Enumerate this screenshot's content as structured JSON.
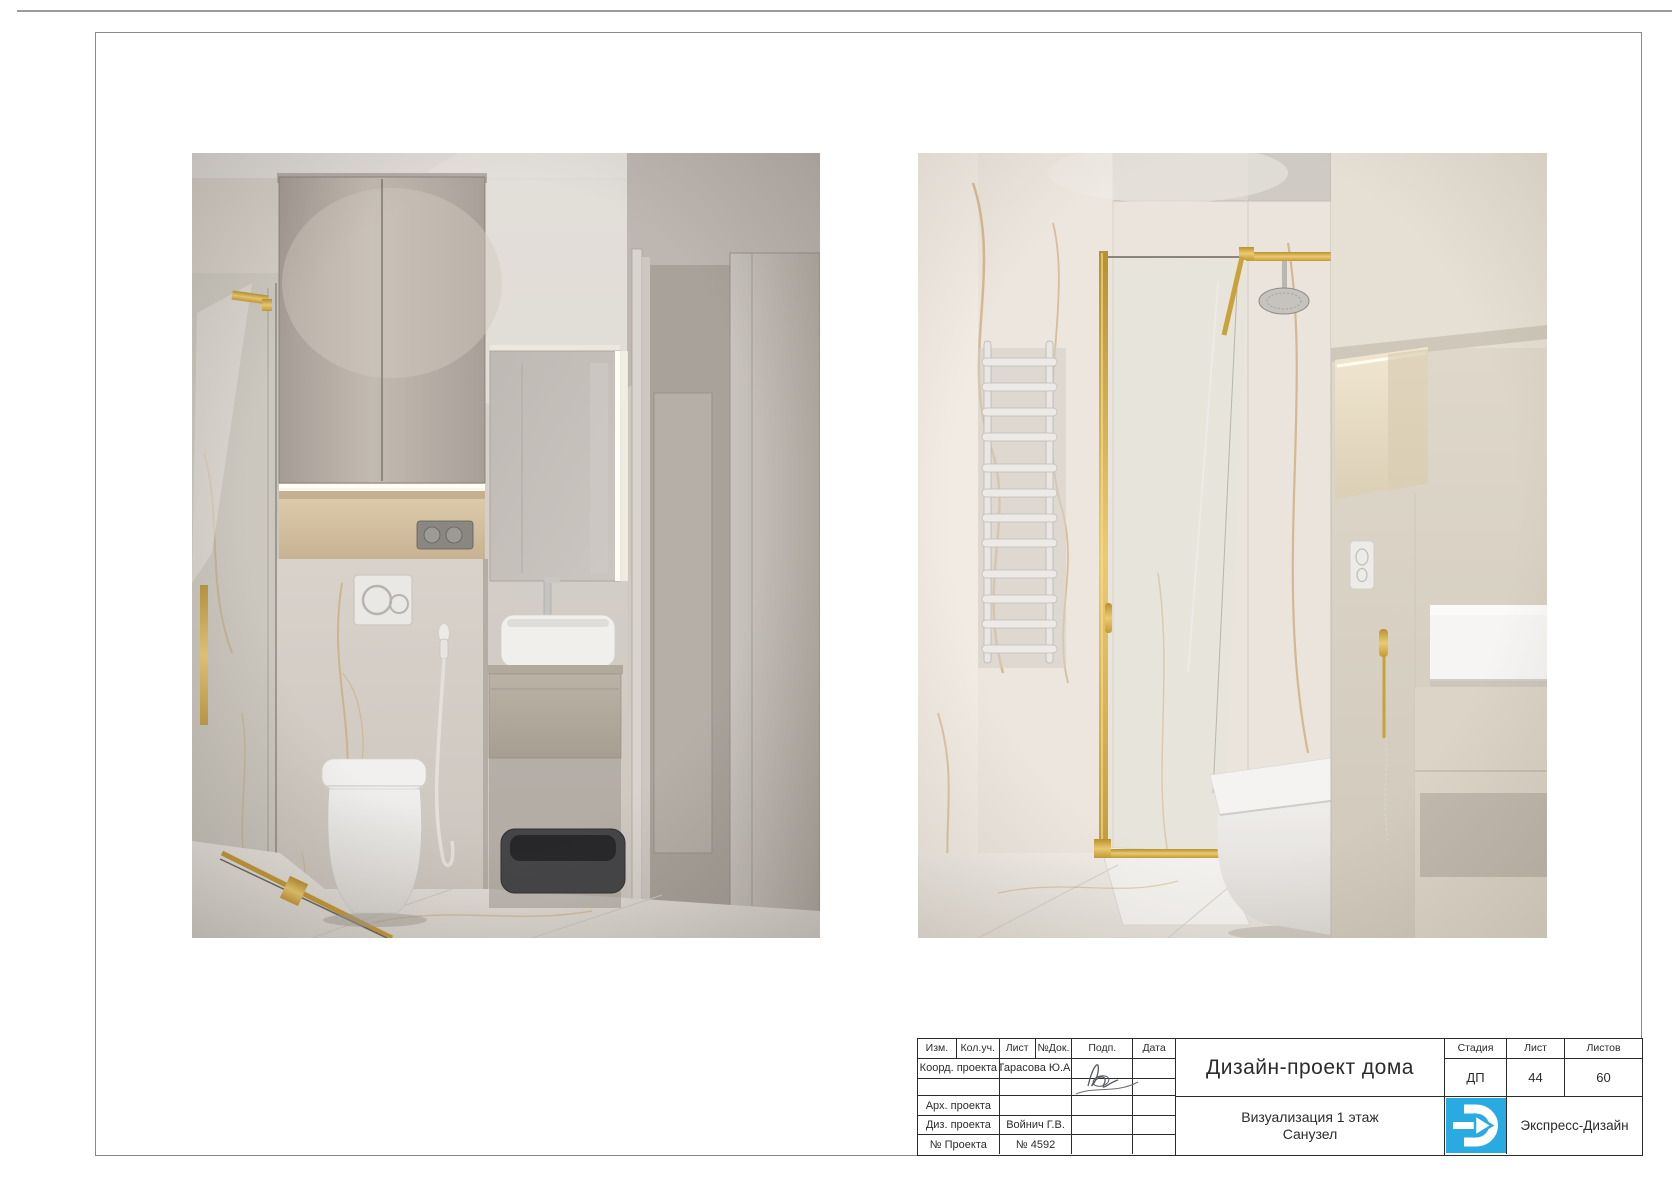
{
  "title_block": {
    "header_cols": [
      "Изм.",
      "Кол.уч.",
      "Лист",
      "№Док.",
      "Подп.",
      "Дата"
    ],
    "rows": [
      {
        "label": "Коорд. проекта",
        "value": "Тарасова Ю.А."
      },
      {
        "label": "",
        "value": ""
      },
      {
        "label": "Арх. проекта",
        "value": ""
      },
      {
        "label": "Диз. проекта",
        "value": "Войнич Г.В."
      },
      {
        "label": "№ Проекта",
        "value": "№ 4592"
      }
    ],
    "project_title": "Дизайн-проект дома",
    "sheet_subtitle_line1": "Визуализация 1 этаж",
    "sheet_subtitle_line2": "Санузел",
    "right_cols": [
      "Стадия",
      "Лист",
      "Листов"
    ],
    "stage": "ДП",
    "sheet_number": "44",
    "sheets_total": "60",
    "company": "Экспресс-Дизайн"
  },
  "renders": {
    "left_alt": "Санузел — инсталляция, шкаф и раковина",
    "right_alt": "Санузел — душевая с золотым профилем"
  },
  "colors": {
    "logo_blue": "#29abe2",
    "gold": "#c9a23c",
    "table_line": "#2b2b2b",
    "frame_line": "#8a8a8a"
  }
}
